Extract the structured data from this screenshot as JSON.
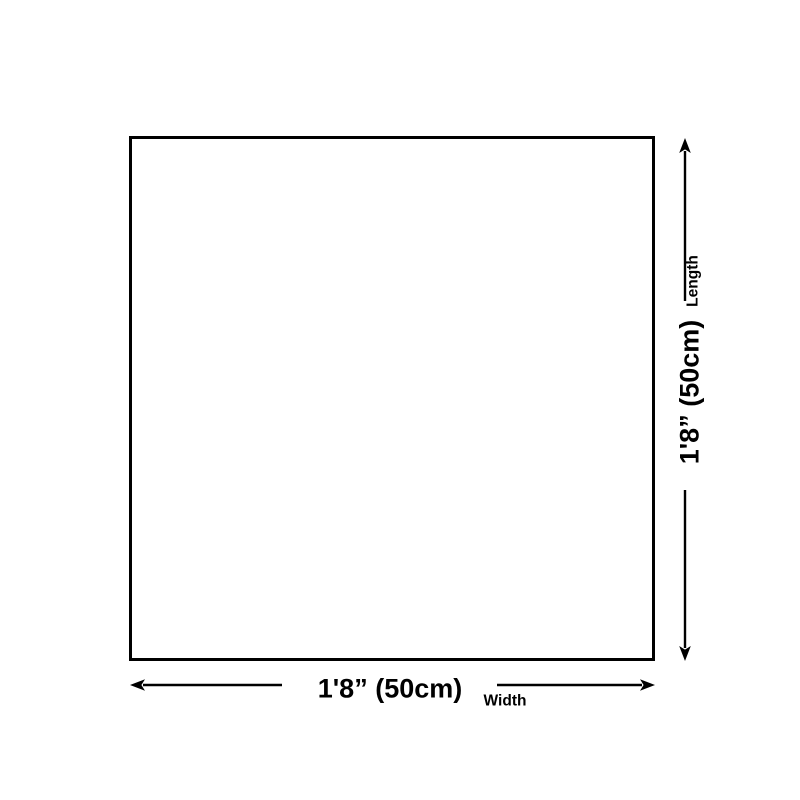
{
  "diagram": {
    "shape": "square-outline",
    "background_color": "#ffffff",
    "line_color": "#000000",
    "text_color": "#000000",
    "length_dimension": {
      "value": "1'8” (50cm)",
      "label": "Length"
    },
    "width_dimension": {
      "value": "1'8” (50cm)",
      "label": "Width"
    }
  }
}
